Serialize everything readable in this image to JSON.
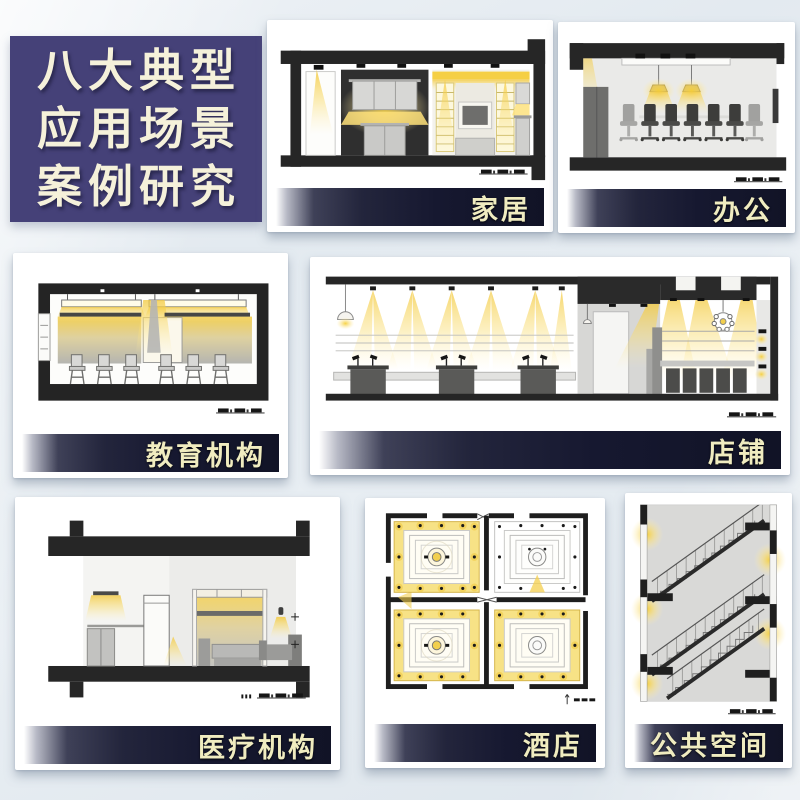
{
  "page": {
    "background_color": "#e6ecf1",
    "card_background": "#ffffff"
  },
  "title_panel": {
    "lines": [
      "八大典型",
      "应用场景",
      "案例研究"
    ],
    "background_color": "#454178",
    "text_color": "#f5f1da"
  },
  "label_banner": {
    "background_start": "#ffffff",
    "background_end": "#111326",
    "text_color": "#f0ecc0"
  },
  "accent_colors": {
    "light_glow_yellow": "#ffe27a",
    "deep_yellow": "#f2c93d",
    "structure_black": "#262626",
    "wall_gray": "#d9d9d7"
  },
  "cards": [
    {
      "id": "home",
      "label": "家居",
      "drawing": "living-room-cabinet-lighting-section"
    },
    {
      "id": "office",
      "label": "办公",
      "drawing": "meeting-room-pendant-lighting-section"
    },
    {
      "id": "education",
      "label": "教育机构",
      "drawing": "classroom-lighting-section"
    },
    {
      "id": "shop",
      "label": "店铺",
      "drawing": "retail-store-spotlighting-section"
    },
    {
      "id": "medical",
      "label": "医疗机构",
      "drawing": "patient-room-lighting-section"
    },
    {
      "id": "hotel",
      "label": "酒店",
      "drawing": "banquet-hall-reflected-ceiling-plan"
    },
    {
      "id": "public-space",
      "label": "公共空间",
      "drawing": "stairwell-lighting-section"
    }
  ],
  "icons": {
    "scale_bar": "graphic scale bar",
    "pendant_lamp": "hanging lamp",
    "chandelier": "cluster chandelier",
    "wall_sconce": "wall lamp",
    "north_scale_mark": "vertical arrow with scale dashes"
  }
}
